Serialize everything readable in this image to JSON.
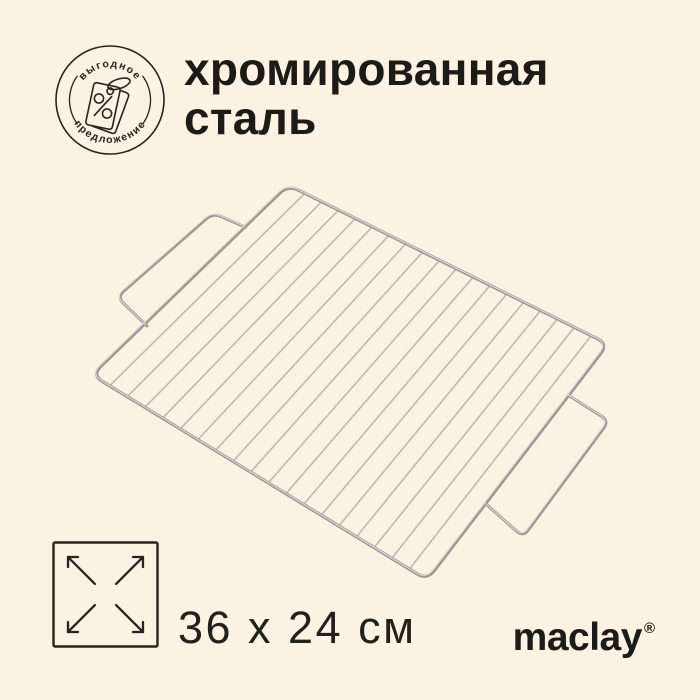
{
  "page": {
    "background": "#faf2e3",
    "ink": "#26241e"
  },
  "badge": {
    "top_text": "выгодное",
    "bottom_text": "предложение",
    "icon": "percent-price-tag-icon",
    "color": "#26241e"
  },
  "title": {
    "line1": "хромированная",
    "line2": "сталь"
  },
  "product": {
    "illustration": "wire-grill-grate",
    "frame_color": "#9b9992",
    "wire_color": "#bcbab4",
    "highlight_color": "#dcdad3"
  },
  "dimensions": {
    "icon": "expand-arrows-icon",
    "label": "36 x 24 см"
  },
  "brand": {
    "name": "maclay",
    "mark": "®"
  }
}
